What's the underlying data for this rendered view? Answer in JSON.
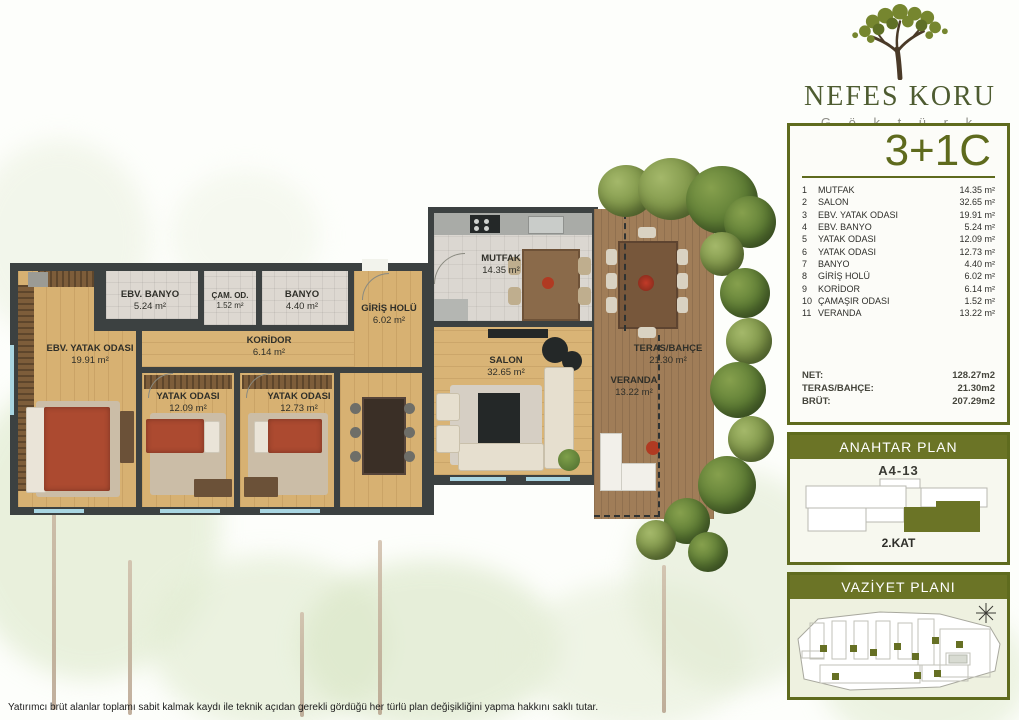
{
  "brand": {
    "name": "NEFES KORU",
    "location": "G ö k t ü r k"
  },
  "unit_card": {
    "title": "3+1C",
    "rooms": [
      {
        "no": "1",
        "name": "MUTFAK",
        "area": "14.35",
        "unit": "m²"
      },
      {
        "no": "2",
        "name": "SALON",
        "area": "32.65",
        "unit": "m²"
      },
      {
        "no": "3",
        "name": "EBV. YATAK ODASI",
        "area": "19.91",
        "unit": "m²"
      },
      {
        "no": "4",
        "name": "EBV. BANYO",
        "area": "5.24",
        "unit": "m²"
      },
      {
        "no": "5",
        "name": "YATAK ODASI",
        "area": "12.09",
        "unit": "m²"
      },
      {
        "no": "6",
        "name": "YATAK ODASI",
        "area": "12.73",
        "unit": "m²"
      },
      {
        "no": "7",
        "name": "BANYO",
        "area": "4.40",
        "unit": "m²"
      },
      {
        "no": "8",
        "name": "GİRİŞ HOLÜ",
        "area": "6.02",
        "unit": "m²"
      },
      {
        "no": "9",
        "name": "KORİDOR",
        "area": "6.14",
        "unit": "m²"
      },
      {
        "no": "10",
        "name": "ÇAMAŞIR ODASI",
        "area": "1.52",
        "unit": "m²"
      },
      {
        "no": "11",
        "name": "VERANDA",
        "area": "13.22",
        "unit": "m²"
      }
    ],
    "totals": [
      {
        "label": "NET:",
        "value": "128.27m2"
      },
      {
        "label": "TERAS/BAHÇE:",
        "value": "21.30m2"
      },
      {
        "label": "BRÜT:",
        "value": "207.29m2"
      }
    ]
  },
  "key_plan": {
    "title": "ANAHTAR PLAN",
    "unit_label": "A4-13",
    "floor_label": "2.KAT"
  },
  "site_plan": {
    "title": "VAZİYET PLANI"
  },
  "floorplan": {
    "rooms": {
      "mutfak": {
        "name": "MUTFAK",
        "area": "14.35 m²"
      },
      "salon": {
        "name": "SALON",
        "area": "32.65 m²"
      },
      "ebv_yatak": {
        "name": "EBV. YATAK ODASI",
        "area": "19.91 m²"
      },
      "ebv_banyo": {
        "name": "EBV. BANYO",
        "area": "5.24 m²"
      },
      "yatak1": {
        "name": "YATAK ODASI",
        "area": "12.09 m²"
      },
      "yatak2": {
        "name": "YATAK ODASI",
        "area": "12.73 m²"
      },
      "banyo": {
        "name": "BANYO",
        "area": "4.40 m²"
      },
      "giris": {
        "name": "GİRİŞ HOLÜ",
        "area": "6.02 m²"
      },
      "koridor": {
        "name": "KORİDOR",
        "area": "6.14 m²"
      },
      "cam_od": {
        "name": "ÇAM. OD.",
        "area": "1.52 m²"
      },
      "veranda": {
        "name": "VERANDA",
        "area": "13.22 m²"
      },
      "teras": {
        "name": "TERAS/BAHÇE",
        "area": "21.30 m²"
      }
    }
  },
  "disclaimer": "Yatırımcı brüt alanlar toplamı sabit kalmak kaydı ile teknik açıdan gerekli gördüğü her türlü plan değişikliğini yapma hakkını saklı tutar.",
  "colors": {
    "olive": "#6b7426",
    "olive_dark": "#5e6a1d",
    "wall": "#3c4141",
    "wood": "#d7b172"
  }
}
